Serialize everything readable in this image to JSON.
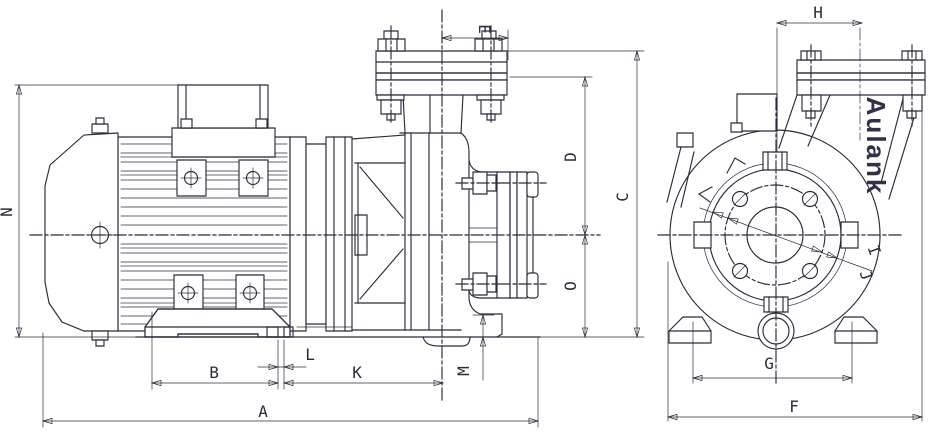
{
  "colors": {
    "ink": "#2b2b3b",
    "paper": "#ffffff",
    "fin_shade": "#9093a8",
    "brand_ink": "#303048"
  },
  "brand": {
    "name": "Aulank"
  },
  "dims": {
    "a": "A",
    "b": "B",
    "c": "C",
    "d": "D",
    "e": "E",
    "f": "F",
    "g": "G",
    "h": "H",
    "i": "I",
    "j": "J",
    "k": "K",
    "l": "L",
    "m": "M",
    "n": "N",
    "o": "O"
  }
}
